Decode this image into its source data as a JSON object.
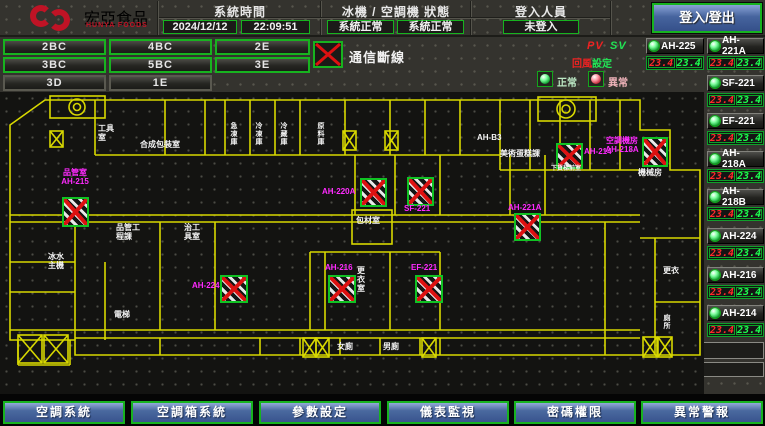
{
  "header": {
    "logo_title": "宏亞食品",
    "logo_subtitle": "HUNYA FOODS",
    "time_label": "系統時間",
    "date": "2024/12/12",
    "time": "22:09:51",
    "status_label": "冰機 / 空調機 狀態",
    "chiller_status": "系統正常",
    "ahu_status": "系統正常",
    "login_label": "登入人員",
    "login_status": "未登入",
    "login_button": "登入/登出"
  },
  "floors": {
    "b1": "2BC",
    "b2": "4BC",
    "b3": "2E",
    "b4": "3BC",
    "b5": "5BC",
    "b6": "3E",
    "b7": "3D",
    "b8": "1E"
  },
  "legend": {
    "comm_fail": "通信斷線",
    "pv": "PV",
    "sv": "SV",
    "set_l": "回風",
    "set_r": "設定",
    "normal": "正常",
    "abnormal": "異常"
  },
  "units": [
    {
      "name": "AH-225",
      "pv": "23.4",
      "sv": "23.4"
    },
    {
      "name": "AH-221A",
      "pv": "23.4",
      "sv": "23.4"
    },
    {
      "name": "SF-221",
      "pv": "23.4",
      "sv": "23.4"
    },
    {
      "name": "EF-221",
      "pv": "23.4",
      "sv": "23.4"
    },
    {
      "name": "AH-218A",
      "pv": "23.4",
      "sv": "23.4"
    },
    {
      "name": "AH-218B",
      "pv": "23.4",
      "sv": "23.4"
    },
    {
      "name": "AH-224",
      "pv": "23.4",
      "sv": "23.4"
    },
    {
      "name": "AH-216",
      "pv": "23.4",
      "sv": "23.4"
    },
    {
      "name": "AH-214",
      "pv": "23.4",
      "sv": "23.4"
    }
  ],
  "plan": {
    "tags": {
      "t1a": "品管室",
      "t1b": "AH-215",
      "t2": "AH-220A",
      "t3": "SF-221",
      "t4": "AH-221A",
      "t5": "AH-214",
      "t6a": "空調機房",
      "t6b": "AH-218A",
      "t7": "AH-224",
      "t8": "AH-216",
      "t9": "EF-221"
    },
    "rooms": {
      "tool": "工具室",
      "prep": "合成包裝室",
      "cold1": "急凍庫",
      "cold2": "冷凍庫",
      "cold3": "冷藏庫",
      "cold4": "原料庫",
      "qc": "品管工程課",
      "jig": "治工具室",
      "chiller": "冰水主機",
      "lift": "電梯",
      "packmat": "包材室",
      "locker": "更衣室",
      "wc_f": "女廁",
      "wc_m": "男廁",
      "ahb3": "AH-B3",
      "art": "美術蛋糕課",
      "freight": "下貨梯前室",
      "mech": "機械房",
      "locker2": "更衣",
      "wc2": "廁所"
    }
  },
  "colors": {
    "accent_green": "#17b31f",
    "alarm_red": "#dd1111",
    "tag_magenta": "#ff2aff",
    "wall_yellow": "#d8d800"
  },
  "footer": {
    "b1": "空調系統",
    "b2": "空調箱系統",
    "b3": "參數設定",
    "b4": "儀表監視",
    "b5": "密碼權限",
    "b6": "異常警報"
  }
}
